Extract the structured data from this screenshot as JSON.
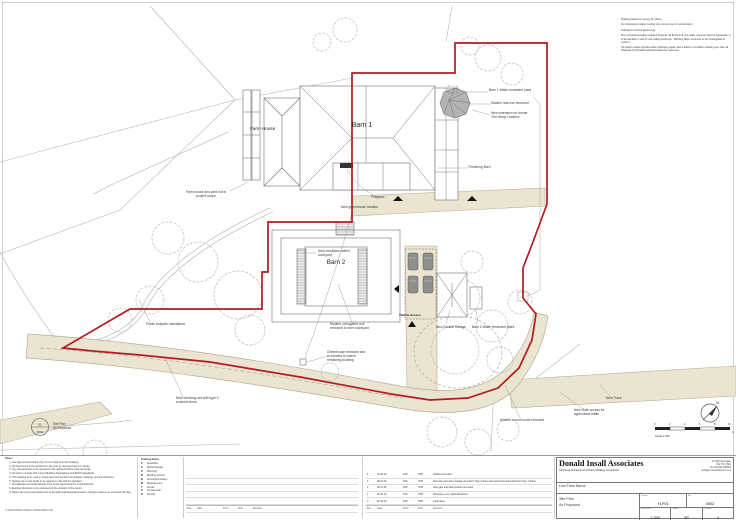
{
  "top_notes": {
    "items": [
      "Drawing based on survey by others.",
      "For discussion/outline costing only, do not use for construction.",
      "Indicative furniture layout only.",
      "Fire compartmentation required between all floors and new walls. Assume that fire separation is to be applied in void of new ceiling build-ups - Building fabric structure to be investigated to confirm.",
      "No works require full decoration following repair works listed on condition drawing set. See all drawings by Donald Insall Associates for reference."
    ]
  },
  "plan": {
    "labels": [
      {
        "text": "Farm house and yard not in\nproject scope"
      },
      {
        "text": "Farm House"
      },
      {
        "text": "Barn 1"
      },
      {
        "text": "Barn 1 Water treatment plant"
      },
      {
        "text": "Modern lean-tos removed"
      },
      {
        "text": "New extension on former\n'Old Hang' Location"
      },
      {
        "text": "Threshing Barn"
      },
      {
        "text": "Fireplace"
      },
      {
        "text": "New greenhouse location"
      },
      {
        "text": "New circulation within\ncourtyard"
      },
      {
        "text": "Barn 2"
      },
      {
        "text": "Modern corrugated roof\nremoved to form courtyard"
      },
      {
        "text": "Vehicle Access"
      },
      {
        "text": "New Double Garage"
      },
      {
        "text": "Barn 2 Water treatment plant"
      },
      {
        "text": "Public footpath maintained"
      },
      {
        "text": "Greenhouse removed and\nre-erected to match\nremaining building"
      },
      {
        "text": "New driveway set with type 3\ncrushed stone"
      },
      {
        "text": "Modern round house removed"
      },
      {
        "text": "New Gate access for\nagricultural traffic"
      },
      {
        "text": "New Track"
      }
    ]
  },
  "compass": {
    "north": "N"
  },
  "scalebar": {
    "numbers": [
      "0",
      "2",
      "4",
      "6",
      "8",
      "10"
    ],
    "unit": "m",
    "label": "Scale 1:200"
  },
  "ref_symbol": {
    "top": "01",
    "bottom": "4002",
    "caption": "Site Plan\nAs Proposed"
  },
  "notes": {
    "title": "Notes:",
    "items": [
      "Use figured dimensions only; do not scale from this drawing.",
      "All dimensions to be checked on site prior to commencement of works.",
      "Any discrepancies to be reported to the architect before work proceeds.",
      "All work to comply with current Building Regulations and British Standards.",
      "This drawing to be read in conjunction with all other consultants' drawings and specifications.",
      "Setting out of new works to be agreed on site with the architect.",
      "All materials and workmanship to be to the approval of the Local Authority.",
      "Existing structures to be protected for the duration of the works.",
      "Report all survey inconsistencies to Donald Insall Associates before changes made to an executed site plan."
    ],
    "copyright": "© 2020 DONALD INSALL ASSOCIATES LTD"
  },
  "drawing_status": {
    "title": "Drawing Status",
    "items": [
      {
        "code": "F",
        "label": "Feasibility"
      },
      {
        "code": "S",
        "label": "Sketch Design"
      },
      {
        "code": "P",
        "label": "Planning"
      },
      {
        "code": "B",
        "label": "Building Control"
      },
      {
        "code": "D",
        "label": "Developed Design"
      },
      {
        "code": "M",
        "label": "Measurement"
      },
      {
        "code": "T",
        "label": "Tender"
      },
      {
        "code": "C",
        "label": "Construction"
      },
      {
        "code": "R",
        "label": "Record"
      }
    ]
  },
  "revisions": {
    "headers": [
      "Rev",
      "Date",
      "Drwn",
      "Auth",
      "Revision"
    ],
    "rows": [
      [
        "4",
        "07.06.20",
        "DJS",
        "TOB",
        "Redline amended"
      ],
      [
        "3",
        "28.01.20",
        "DJS",
        "TOB",
        "Driveway amended. Garage amended. Type 3 Stone driveway finish amended from Type 1 Stone"
      ],
      [
        "2",
        "06.11.19",
        "DJS",
        "TOB",
        "New gate and track position amended"
      ],
      [
        "1",
        "25.10.19",
        "DJS",
        "TOB",
        "Driveway re-set, label alterations"
      ],
      [
        "0",
        "02.10.19",
        "DJS",
        "TOB",
        "Initial issue"
      ]
    ]
  },
  "title_block": {
    "name": "Donald Insall Associates",
    "tagline": "Chartered Architects and Historic Building Consultants",
    "address": [
      "10 High Petergate",
      "York YO1 7EN",
      "+44 (0)1904 538550",
      "york@insall-architects.co.uk"
    ],
    "project_name": "Low Farm Barns",
    "title_line1": "Site Plan",
    "title_line2": "As Proposed",
    "fields": {
      "project_label": "Project",
      "project": "YLF01",
      "no_label": "No.",
      "no": "4002",
      "scale_label": "Scale (A1)",
      "scale": "1:200",
      "status_label": "Status",
      "status": "3P",
      "revision_label": "Revision",
      "revision": "4"
    }
  },
  "colors": {
    "boundary_red": "#b01c20",
    "driveway_beige": "#ebe4d0"
  }
}
